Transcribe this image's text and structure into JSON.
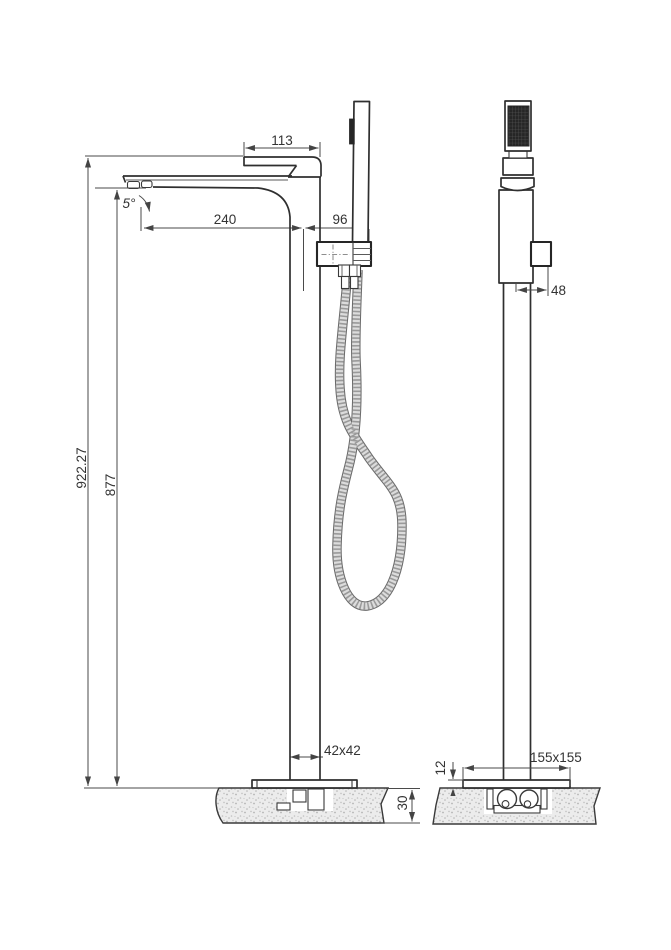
{
  "drawing": {
    "kind": "freestanding-bath-mixer-two-view-technical-drawing",
    "dimensions": {
      "lever_width": "113",
      "spout_angle": "5°",
      "spout_reach": "240",
      "shower_offset": "96",
      "overall_height": "922.27",
      "spout_height": "877",
      "bracket_offset": "48",
      "column_section": "42x42",
      "floor_recess_depth": "30",
      "base_plate_thickness": "12",
      "base_plate_size": "155x155"
    },
    "colors": {
      "background": "#ffffff",
      "line": "#2f2f2f",
      "dim_line": "#4a4a4a",
      "text": "#333333",
      "hose_gray": "#9a9a9a",
      "spray_face": "#262626",
      "floor_fill": "#ececec"
    }
  }
}
